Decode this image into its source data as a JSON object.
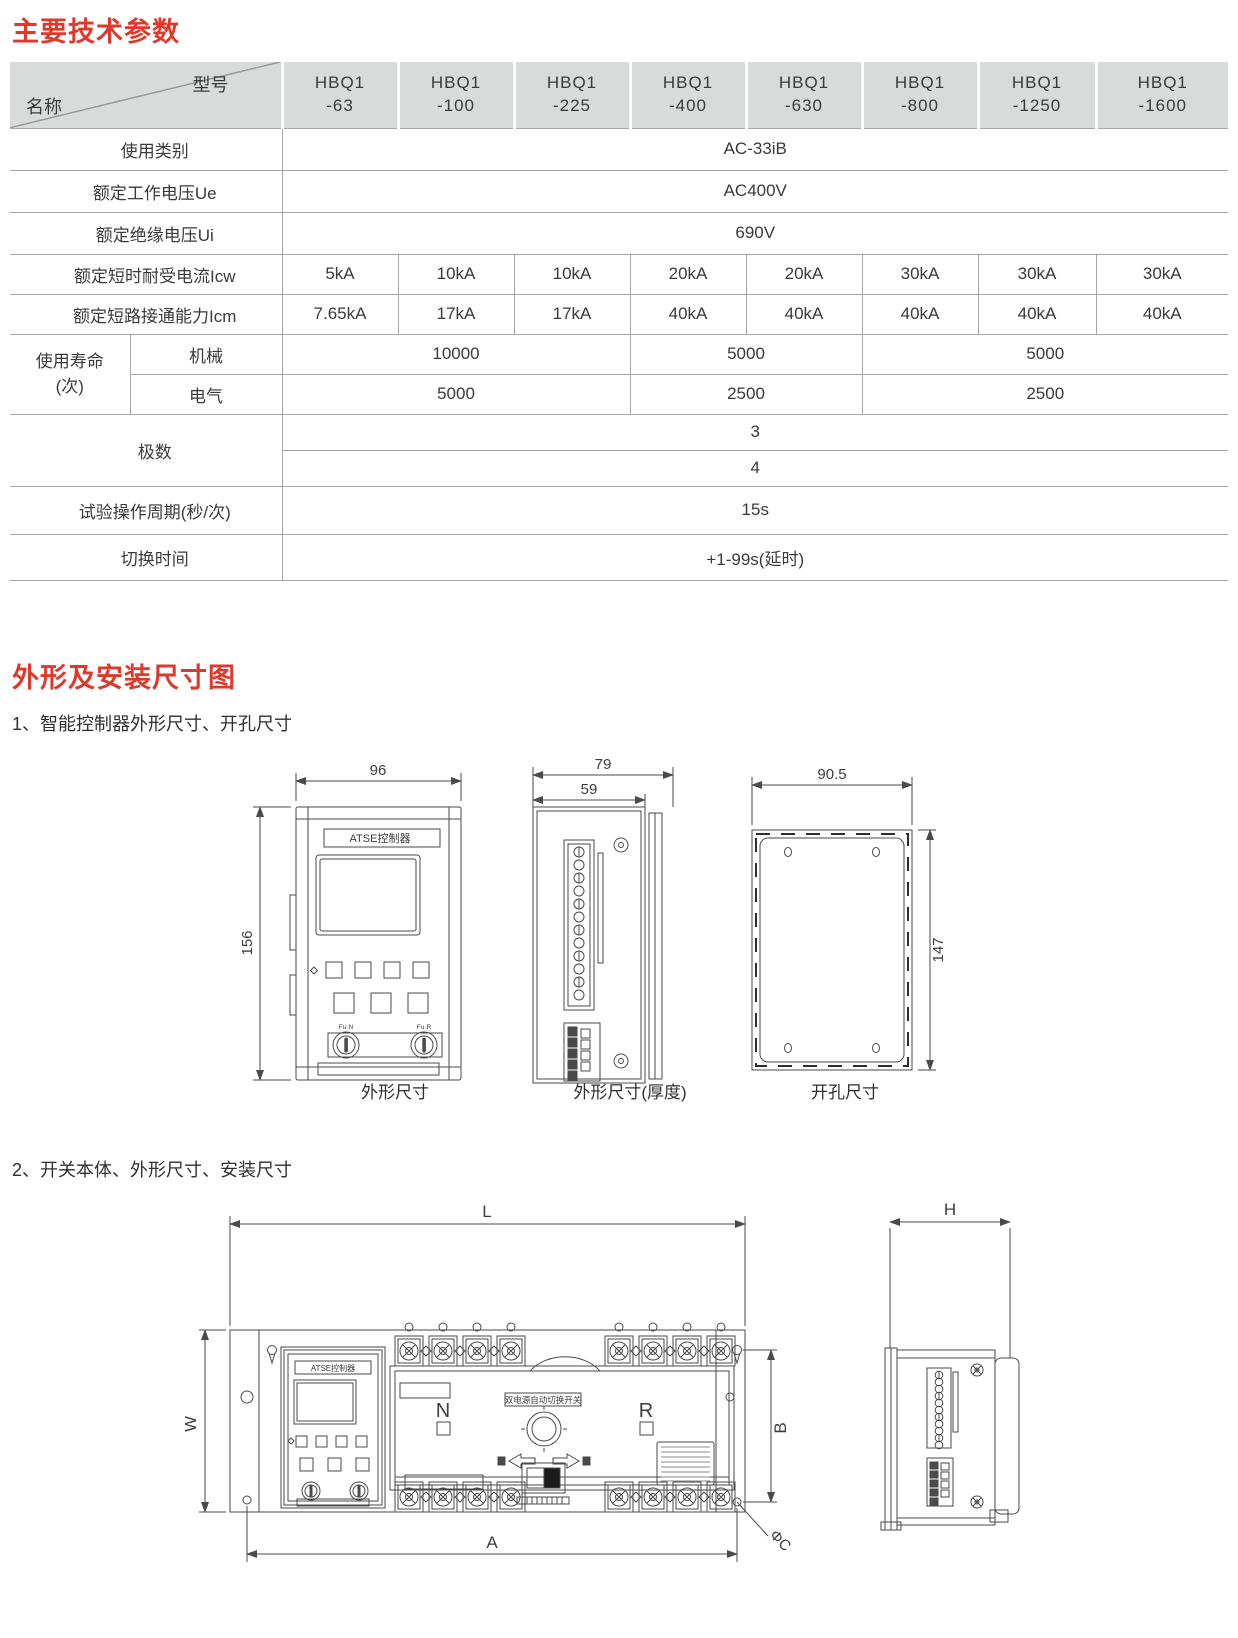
{
  "page": {
    "section1_title": "主要技术参数",
    "section2_title": "外形及安装尺寸图",
    "sub1": "1、智能控制器外形尺寸、开孔尺寸",
    "sub2": "2、开关本体、外形尺寸、安装尺寸",
    "accent_red": "#e0382a",
    "header_gray": "#d9dada"
  },
  "table": {
    "corner": {
      "model": "型号",
      "name": "名称"
    },
    "models": [
      {
        "l1": "HBQ1",
        "l2": "-63"
      },
      {
        "l1": "HBQ1",
        "l2": "-100"
      },
      {
        "l1": "HBQ1",
        "l2": "-225"
      },
      {
        "l1": "HBQ1",
        "l2": "-400"
      },
      {
        "l1": "HBQ1",
        "l2": "-630"
      },
      {
        "l1": "HBQ1",
        "l2": "-800"
      },
      {
        "l1": "HBQ1",
        "l2": "-1250"
      },
      {
        "l1": "HBQ1",
        "l2": "-1600"
      }
    ],
    "rows": {
      "usage": {
        "label": "使用类别",
        "value": "AC-33iB"
      },
      "ue": {
        "label": "额定工作电压Ue",
        "value": "AC400V"
      },
      "ui": {
        "label": "额定绝缘电压Ui",
        "value": "690V"
      },
      "icw": {
        "label": "额定短时耐受电流Icw",
        "values": [
          "5kA",
          "10kA",
          "10kA",
          "20kA",
          "20kA",
          "30kA",
          "30kA",
          "30kA"
        ]
      },
      "icm": {
        "label": "额定短路接通能力Icm",
        "values": [
          "7.65kA",
          "17kA",
          "17kA",
          "40kA",
          "40kA",
          "40kA",
          "40kA",
          "40kA"
        ]
      },
      "life": {
        "label_line1": "使用寿命",
        "label_line2": "(次)",
        "mech": {
          "label": "机械",
          "values": [
            "10000",
            "5000",
            "5000"
          ]
        },
        "elec": {
          "label": "电气",
          "values": [
            "5000",
            "2500",
            "2500"
          ]
        }
      },
      "poles": {
        "label": "极数",
        "values": [
          "3",
          "4"
        ]
      },
      "test": {
        "label": "试验操作周期(秒/次)",
        "value": "15s"
      },
      "switch_time": {
        "label": "切换时间",
        "value": "+1-99s(延时)"
      }
    }
  },
  "drawings": {
    "controller": {
      "panel_label": "ATSE控制器",
      "key_left": "Fu·N",
      "key_right": "Fu·R",
      "dim_width": "96",
      "dim_height": "156",
      "dim_depth_total": "79",
      "dim_depth_body": "59",
      "dim_cut_width": "90.5",
      "dim_cut_height": "147",
      "captions": {
        "front": "外形尺寸",
        "side": "外形尺寸(厚度)",
        "cutout": "开孔尺寸"
      }
    },
    "switch_body": {
      "controller_label": "ATSE控制器",
      "plate_label": "双电源自动切换开关",
      "pos_left": "N",
      "pos_right": "R",
      "dim_length": "L",
      "dim_width": "W",
      "dim_height": "H",
      "dim_a": "A",
      "dim_b": "B",
      "dim_c": "ΦC"
    }
  }
}
